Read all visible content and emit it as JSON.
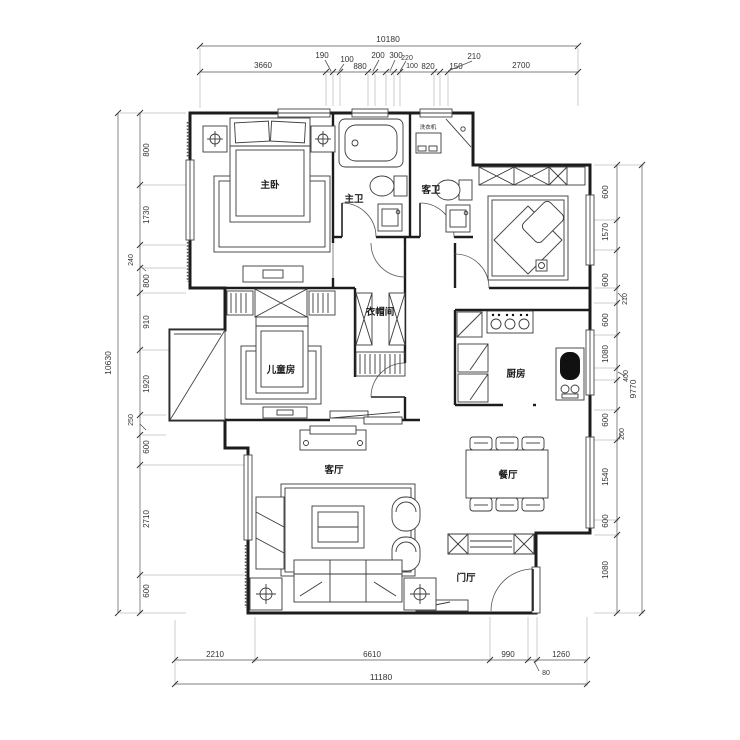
{
  "plan": {
    "rooms": {
      "master_bedroom": "主卧",
      "master_bath": "主卫",
      "guest_bath": "客卫",
      "washing_machine": "洗衣机",
      "cloakroom": "衣帽间",
      "kids_room": "儿童房",
      "kitchen": "厨房",
      "living_room": "客厅",
      "dining_room": "餐厅",
      "foyer": "门厅"
    },
    "colors": {
      "line": "#1c1c1c",
      "background": "#ffffff"
    }
  },
  "dims": {
    "top": {
      "total": "10180",
      "segments": [
        "3660",
        "190",
        "100",
        "880",
        "200",
        "300",
        "220",
        "100",
        "820",
        "150",
        "210",
        "2700"
      ]
    },
    "left": {
      "total": "10630",
      "segments": [
        "800",
        "1730",
        "240",
        "800",
        "910",
        "1920",
        "250",
        "600",
        "2710",
        "600"
      ]
    },
    "right": {
      "total": "9770",
      "segments": [
        "600",
        "1570",
        "600",
        "210",
        "600",
        "1080",
        "400",
        "600",
        "200",
        "1540",
        "600",
        "1080"
      ]
    },
    "bottom": {
      "total": "11180",
      "segments": [
        "2210",
        "6610",
        "990",
        "80",
        "1260"
      ]
    }
  }
}
